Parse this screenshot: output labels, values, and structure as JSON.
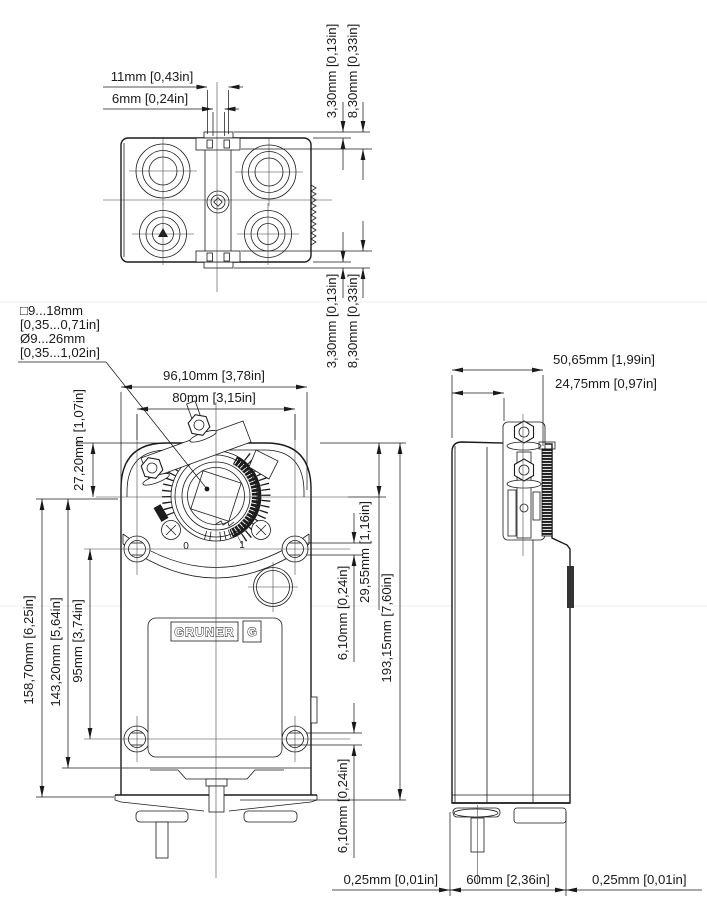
{
  "drawing": {
    "kind": "technical dimension drawing",
    "views": [
      "top view",
      "front view",
      "side view"
    ],
    "units": "mm [inch]",
    "colors": {
      "line": "#1a1a1a",
      "background": "#ffffff",
      "faint_guide": "#ececec"
    }
  },
  "top_view": {
    "width_tab": "11mm [0,43in]",
    "width_slot": "6mm [0,24in]",
    "offset_small_top": "3,30mm [0,13in]",
    "offset_large_top": "8,30mm [0,33in]",
    "offset_small_bottom": "3,30mm [0,13in]",
    "offset_large_bottom": "8,30mm [0,33in]"
  },
  "front_view": {
    "shaft_note": {
      "line1": "□9...18mm",
      "line2": "[0,35...0,71in]",
      "line3": "Ø9...26mm",
      "line4": "[0,35...1,02in]"
    },
    "overall_width": "96,10mm [3,78in]",
    "hole_spacing_width": "80mm [3,15in]",
    "top_to_shaft": "27,20mm [1,07in]",
    "shaft_to_bottom_total": "158,70mm [6,25in]",
    "shaft_to_housing_bottom": "143,20mm [5,64in]",
    "hole_spacing_height": "95mm [3,74in]",
    "top_to_shaft_right": "29,55mm [1,16in]",
    "overall_height": "193,15mm [7,60in]",
    "hole_flat_upper": "6,10mm [0,24in]",
    "hole_flat_lower": "6,10mm [0,24in]",
    "scale_zero": "0",
    "scale_one": "1",
    "logo_text": "GRUNER",
    "logo_emblem": "G"
  },
  "side_view": {
    "overall_depth": "50,65mm [1,99in]",
    "bracket_depth": "24,75mm [0,97in]",
    "clearance_left": "0,25mm [0,01in]",
    "body_depth": "60mm [2,36in]",
    "clearance_right": "0,25mm [0,01in]"
  }
}
